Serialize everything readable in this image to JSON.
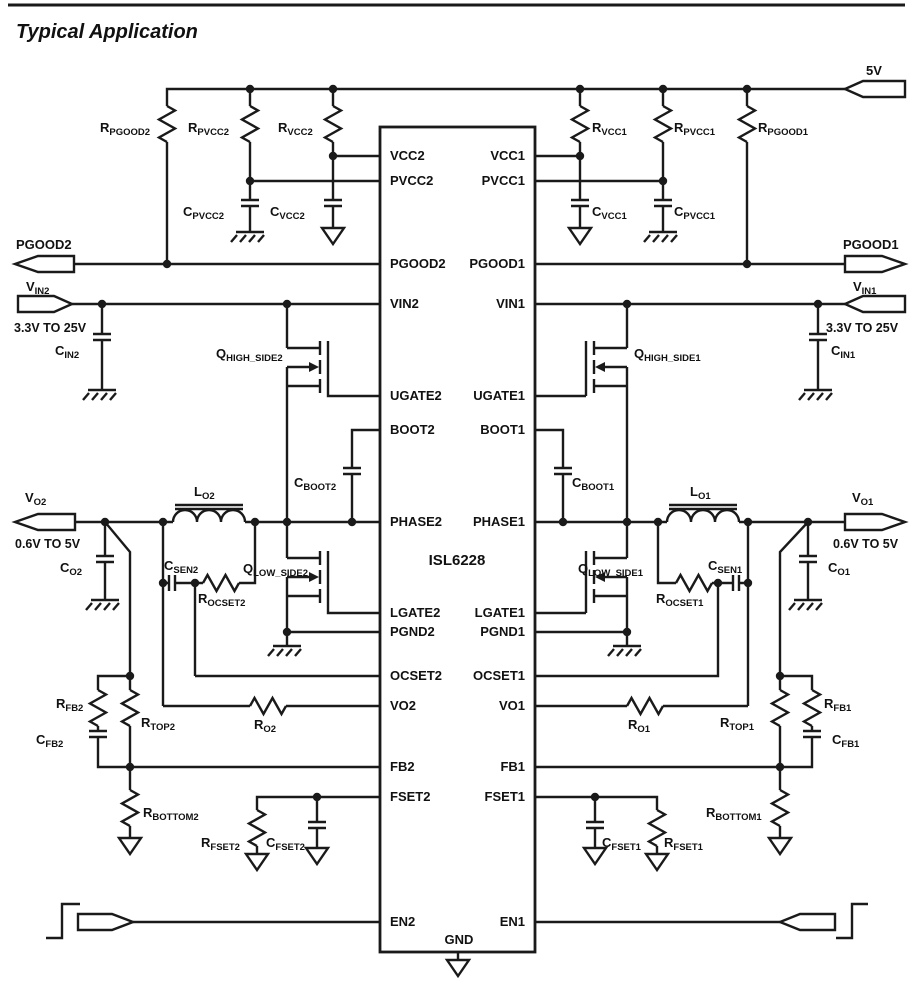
{
  "title": "Typical Application",
  "ic": {
    "name": "ISL6228",
    "gnd_pin": "GND",
    "left_pins": {
      "vcc2": "VCC2",
      "pvcc2": "PVCC2",
      "pgood2": "PGOOD2",
      "vin2": "VIN2",
      "ugate2": "UGATE2",
      "boot2": "BOOT2",
      "phase2": "PHASE2",
      "lgate2": "LGATE2",
      "pgnd2": "PGND2",
      "ocset2": "OCSET2",
      "vo2": "VO2",
      "fb2": "FB2",
      "fset2": "FSET2",
      "en2": "EN2"
    },
    "right_pins": {
      "vcc1": "VCC1",
      "pvcc1": "PVCC1",
      "pgood1": "PGOOD1",
      "vin1": "VIN1",
      "ugate1": "UGATE1",
      "boot1": "BOOT1",
      "phase1": "PHASE1",
      "lgate1": "LGATE1",
      "pgnd1": "PGND1",
      "ocset1": "OCSET1",
      "vo1": "VO1",
      "fb1": "FB1",
      "fset1": "FSET1",
      "en1": "EN1"
    }
  },
  "ports": {
    "supply_5v": "5V",
    "pgood2": "PGOOD2",
    "pgood1": "PGOOD1",
    "vin2": {
      "main": "V",
      "sub": "IN2"
    },
    "vin1": {
      "main": "V",
      "sub": "IN1"
    },
    "vin_range": "3.3V TO 25V",
    "vo2": {
      "main": "V",
      "sub": "O2"
    },
    "vo1": {
      "main": "V",
      "sub": "O1"
    },
    "vo_range": "0.6V TO 5V"
  },
  "components": {
    "rpgood2": {
      "main": "R",
      "sub": "PGOOD2"
    },
    "rpvcc2": {
      "main": "R",
      "sub": "PVCC2"
    },
    "rvcc2": {
      "main": "R",
      "sub": "VCC2"
    },
    "cpvcc2": {
      "main": "C",
      "sub": "PVCC2"
    },
    "cvcc2": {
      "main": "C",
      "sub": "VCC2"
    },
    "rvcc1": {
      "main": "R",
      "sub": "VCC1"
    },
    "rpvcc1": {
      "main": "R",
      "sub": "PVCC1"
    },
    "rpgood1": {
      "main": "R",
      "sub": "PGOOD1"
    },
    "cvcc1": {
      "main": "C",
      "sub": "VCC1"
    },
    "cpvcc1": {
      "main": "C",
      "sub": "PVCC1"
    },
    "cin2": {
      "main": "C",
      "sub": "IN2"
    },
    "cin1": {
      "main": "C",
      "sub": "IN1"
    },
    "qhighside2": {
      "main": "Q",
      "sub": "HIGH_SIDE2"
    },
    "qhighside1": {
      "main": "Q",
      "sub": "HIGH_SIDE1"
    },
    "cboot2": {
      "main": "C",
      "sub": "BOOT2"
    },
    "cboot1": {
      "main": "C",
      "sub": "BOOT1"
    },
    "lo2": {
      "main": "L",
      "sub": "O2"
    },
    "lo1": {
      "main": "L",
      "sub": "O1"
    },
    "co2": {
      "main": "C",
      "sub": "O2"
    },
    "co1": {
      "main": "C",
      "sub": "O1"
    },
    "csen2": {
      "main": "C",
      "sub": "SEN2"
    },
    "rocset2": {
      "main": "R",
      "sub": "OCSET2"
    },
    "csen1": {
      "main": "C",
      "sub": "SEN1"
    },
    "rocset1": {
      "main": "R",
      "sub": "OCSET1"
    },
    "qlowside2": {
      "main": "Q",
      "sub": "LOW_SIDE2"
    },
    "qlowside1": {
      "main": "Q",
      "sub": "LOW_SIDE1"
    },
    "ro2": {
      "main": "R",
      "sub": "O2"
    },
    "ro1": {
      "main": "R",
      "sub": "O1"
    },
    "rfb2": {
      "main": "R",
      "sub": "FB2"
    },
    "cfb2": {
      "main": "C",
      "sub": "FB2"
    },
    "rtop2": {
      "main": "R",
      "sub": "TOP2"
    },
    "rbottom2": {
      "main": "R",
      "sub": "BOTTOM2"
    },
    "rfb1": {
      "main": "R",
      "sub": "FB1"
    },
    "cfb1": {
      "main": "C",
      "sub": "FB1"
    },
    "rtop1": {
      "main": "R",
      "sub": "TOP1"
    },
    "rbottom1": {
      "main": "R",
      "sub": "BOTTOM1"
    },
    "rfset2": {
      "main": "R",
      "sub": "FSET2"
    },
    "cfset2": {
      "main": "C",
      "sub": "FSET2"
    },
    "cfset1": {
      "main": "C",
      "sub": "FSET1"
    },
    "rfset1": {
      "main": "R",
      "sub": "FSET1"
    }
  }
}
